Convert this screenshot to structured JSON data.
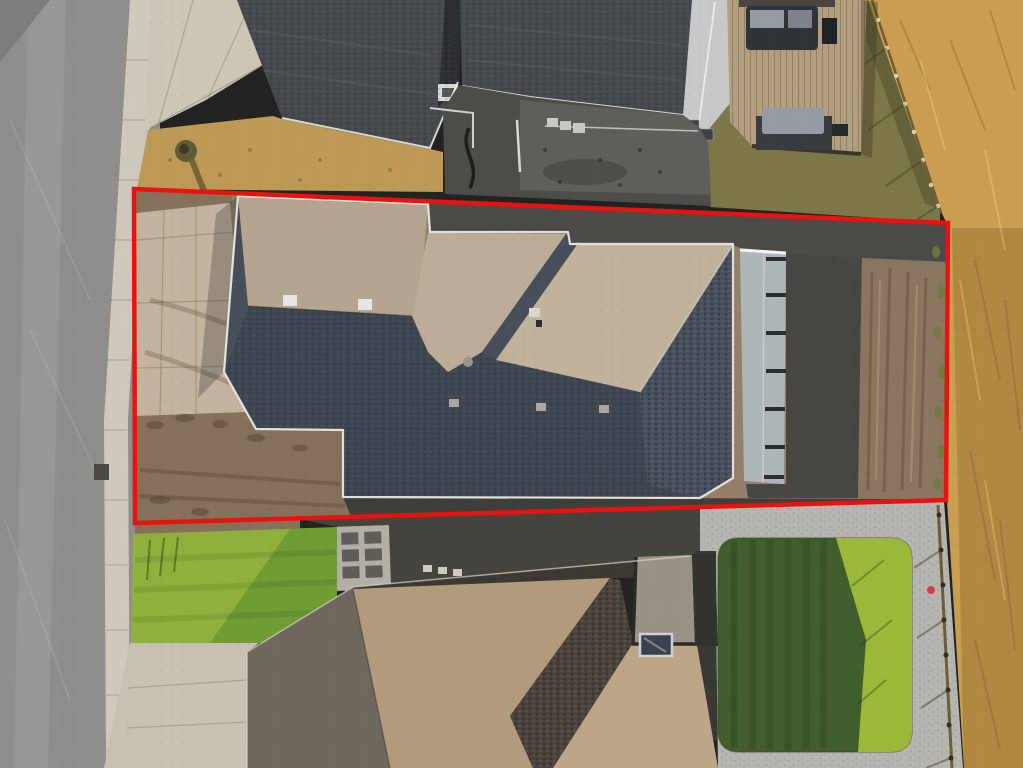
{
  "scene": {
    "type": "aerial-drone-photo",
    "subject": "top-down view of a newly built house on a graded dirt lot outlined in red, between two neighboring homes",
    "orientation": "street on the left, open golden field on the right"
  },
  "lot": {
    "outline_points": "134,189 948,223 946,500 135,523",
    "outline_color": "#e8130f",
    "stroke_width": 4.5
  },
  "palette": {
    "red_outline": "#e8130f",
    "road": "#8f8e8c",
    "road_light": "#a2a09d",
    "road_patch": "#7e7d7b",
    "curb": "#cfc8bc",
    "apron": "#cdc5b6",
    "concrete_pad": "#c2b49e",
    "dry_grass": "#bc9a55",
    "tree_green": "#5f5b34",
    "roof_charcoal": "#45484d",
    "gap_dark": "#2c2e31",
    "chimney": "#d9d9d5",
    "gable": "#c6c8ca",
    "deck_wood": "#b29f82",
    "deck_line": "#6e5c3f",
    "tub_dark": "#2f3337",
    "cushion": "#949ba2",
    "yard_olive": "#7b7748",
    "field_gold": "#c99e51",
    "field_gold_dark": "#a87f3e",
    "fence_brown": "#6b5c3a",
    "post_light": "#e4d3a2",
    "lot_dirt": "#94806a",
    "dirt_rough": "#85715a",
    "dirt_clump": "#5c4d3c",
    "shadow_ground": "#4e4c48",
    "shadow_strip": "#4b4a46",
    "dirt_mound": "#8a755e",
    "weeds": "#6e7a3e",
    "tan_1": "#b3a58f",
    "tan_2": "#bbad97",
    "tan_3": "#c0b29b",
    "slate_1": "#3f4650",
    "slate_2": "#474e59",
    "fascia": "#eae8e3",
    "wall_panel": "#aeb6ba",
    "post_dark": "#282c30",
    "dark_strip": "#3f3e3a",
    "dark_strip2": "#45433d",
    "gravel": "#b6b5af",
    "lawn_dark": "#3f5e2c",
    "lawn_bright": "#9cb838",
    "lawn_left": "#6f9c33",
    "lawn_left_bright": "#a9c144",
    "drive_concrete": "#c8c0b0",
    "pad_concrete": "#b4afa4",
    "paver": "#5f5d57",
    "lower_tan": "#b29b7d",
    "lower_tan2": "#bda687",
    "lower_west": "#6e675e",
    "lower_hip": "#4a433b",
    "lower_north": "#3b3932",
    "courtyard": "#9a9287",
    "sky_frame": "#ccd2d5",
    "sky_glass": "#39424d",
    "marker_red": "#d2404e"
  },
  "features": {
    "left": "asphalt street with concrete curb and gutter",
    "top": "neighboring house with charcoal shingle roof and wooden deck with patio furniture",
    "center": "subject house with tan sunlit and slate shadowed roof planes inside red property outline",
    "right": "dry golden pasture behind a wood fence",
    "bottom": "neighboring house with brown shingle roof, sodded lawns and gravel landscaping"
  }
}
